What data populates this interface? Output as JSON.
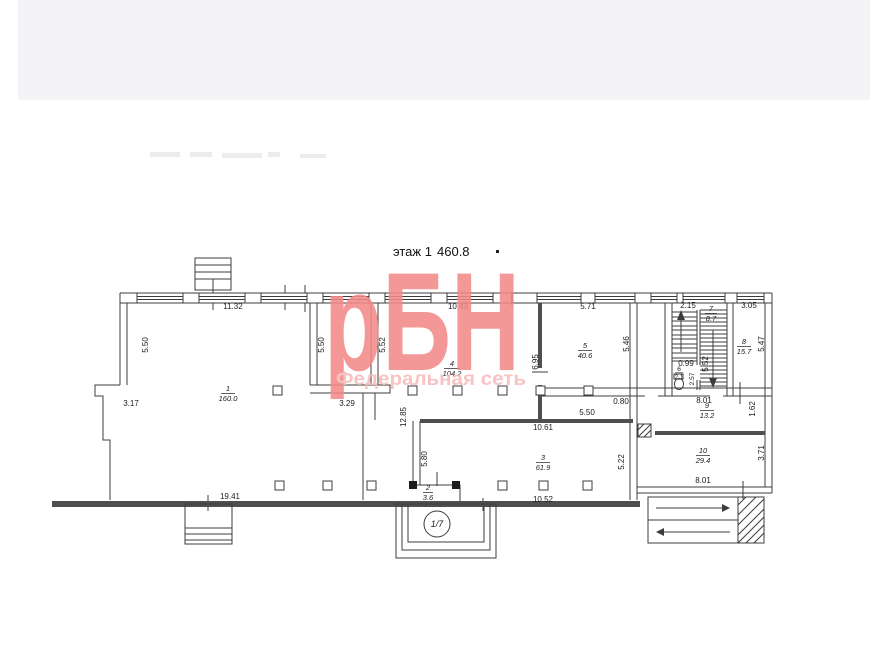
{
  "header": {
    "floor_label": "этаж 1",
    "total_area": "460.8"
  },
  "watermark": {
    "brand": "рБН",
    "subtitle": "Федеральная сеть",
    "brand_color": "#f28a88",
    "subtitle_color": "#f5bcba"
  },
  "plan": {
    "entrance_label": "1/7",
    "rooms": [
      {
        "num": "1",
        "area": "160.0"
      },
      {
        "num": "2",
        "area": "3.6"
      },
      {
        "num": "3",
        "area": "61.9"
      },
      {
        "num": "4",
        "area": "104.2"
      },
      {
        "num": "5",
        "area": "40.6"
      },
      {
        "num": "6",
        "area": "2.1"
      },
      {
        "num": "7",
        "area": "8.7"
      },
      {
        "num": "8",
        "area": "15.7"
      },
      {
        "num": "9",
        "area": "13.2"
      },
      {
        "num": "10",
        "area": "29.4"
      }
    ],
    "dims": {
      "top_left": "11.32",
      "top_mid": "10.43",
      "top_right": "5.71",
      "stair_top": "2.15",
      "room8_top": "3.05",
      "left_wall": "5.50",
      "room1_right": "5.50",
      "room4_left": "5.52",
      "room4_right": "6.95",
      "room5_right": "5.46",
      "room8_right": "5.47",
      "step_left": "3.17",
      "step_mid": "3.29",
      "corridor": "12.85",
      "room3_top": "10.61",
      "corr_width": "5.50",
      "corr_small": "0.80",
      "stair_small": "0.99",
      "stair_right": "5.52",
      "room6_height": "2.57",
      "room9_top": "8.01",
      "room9_right": "1.62",
      "room3_right": "5.22",
      "room3_left": "5.80",
      "room10_right": "3.71",
      "room10_bottom": "8.01",
      "bottom_left": "19.41",
      "room3_bottom": "10.52"
    }
  }
}
